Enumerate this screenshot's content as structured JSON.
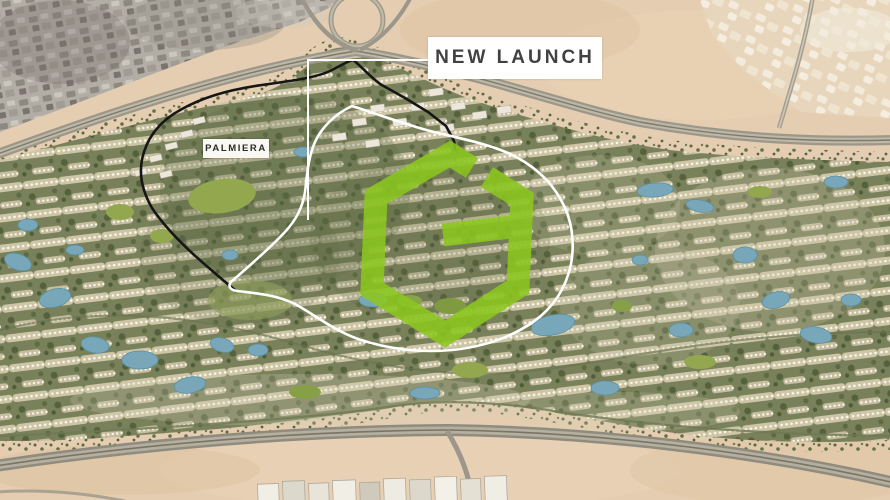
{
  "map": {
    "new_launch": {
      "label": "NEW LAUNCH"
    },
    "community": {
      "label": "PALMIERA"
    },
    "logo": {
      "icon": "hexagon-g-logo-icon",
      "color": "#8bc71e"
    },
    "colors": {
      "logo_green": "#8bc71e",
      "desert_sand": "#e4cdb0",
      "community_olive": "#79815b",
      "water_blue": "#78a7ba",
      "park_green": "#93a74f",
      "boundary_black": "#161616",
      "boundary_white": "#ffffff",
      "label_bg": "#ffffff",
      "label_text": "#414141",
      "city_gray": "#b2ada5"
    }
  }
}
